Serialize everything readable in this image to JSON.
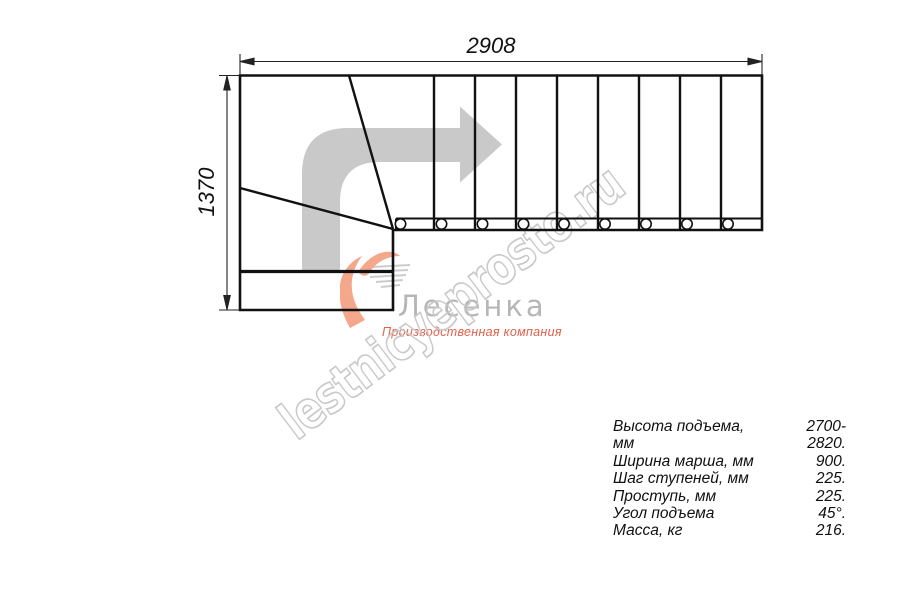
{
  "dimensions": {
    "top": "2908",
    "left": "1370"
  },
  "watermark": {
    "text": "lestnicyeprosto.ru"
  },
  "logo": {
    "brand": "Лесенка",
    "subtitle": "Производственная компания"
  },
  "specs": {
    "rows": [
      {
        "label": "Высота подъема, мм",
        "value": "2700-2820."
      },
      {
        "label": "Ширина марша, мм",
        "value": "900."
      },
      {
        "label": "Шаг ступеней, мм",
        "value": "225."
      },
      {
        "label": "Проступь, мм",
        "value": "225."
      },
      {
        "label": "Угол подъема",
        "value": "45°."
      },
      {
        "label": "Масса, кг",
        "value": "216."
      }
    ]
  },
  "icons": {
    "direction_arrow": "turn-right-arrow",
    "logo_swirl": "flame-swirl-icon",
    "logo_lines": "speed-lines-icon"
  },
  "colors": {
    "line": "#111111",
    "arrow_gray": "#c9c9c9",
    "watermark_gray": "#c9c9c9",
    "logo_coral": "#f5a78c",
    "logo_red": "#e4604b",
    "logo_gray": "#b6b6b6"
  }
}
